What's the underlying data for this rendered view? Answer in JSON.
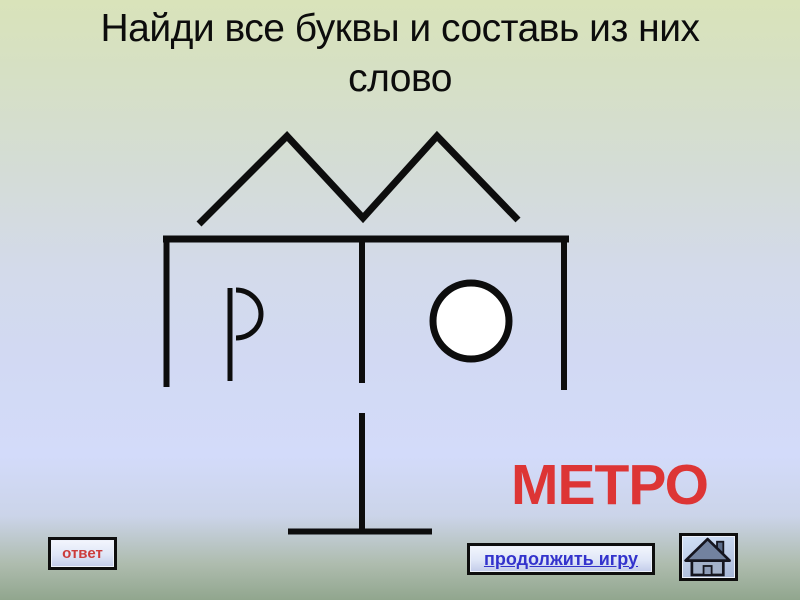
{
  "title": {
    "line1": "Найди все буквы и составь из них",
    "line2": "слово"
  },
  "answer": {
    "word": "МЕТРО",
    "color": "#dd3535"
  },
  "buttons": {
    "answer": {
      "label": "ответ",
      "text_color": "#cc3b3b"
    },
    "continue": {
      "label": "продолжить игру",
      "text_color": "#3333cc"
    },
    "home": {
      "icon": "home-icon"
    }
  },
  "puzzle_drawing": {
    "shape_names": [
      "zigzag-m-line",
      "shelf-e-shape",
      "letter-r-glyph",
      "circle-o-glyph",
      "inverted-t-glyph"
    ],
    "stroke_color": "#0d0d0d"
  }
}
